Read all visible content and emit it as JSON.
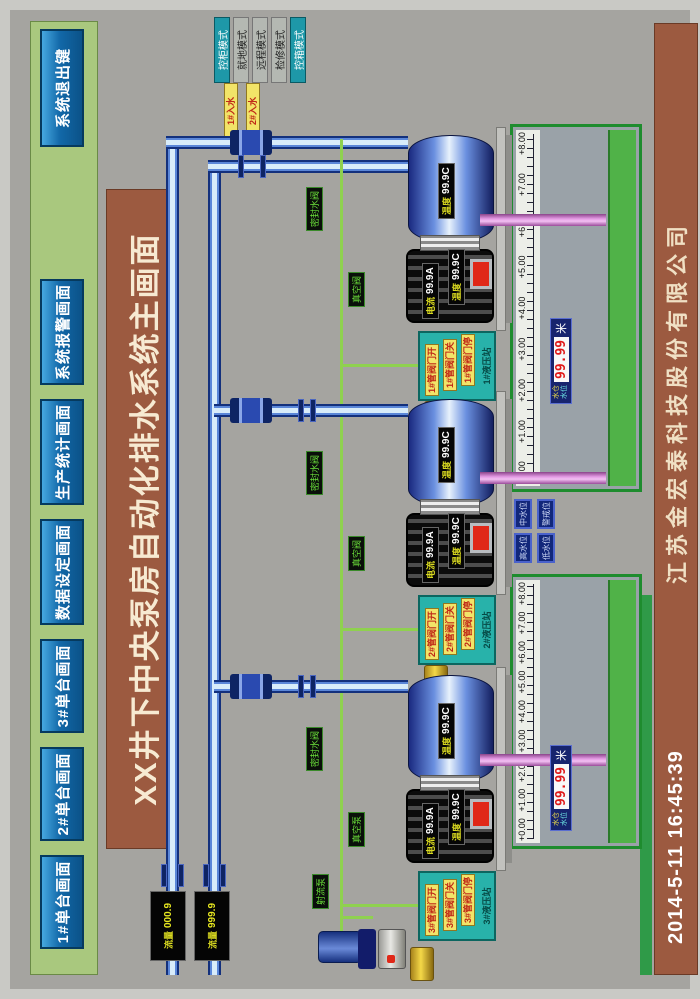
{
  "title": "XX井下中央泵房自动化排水系统主画面",
  "nav": {
    "buttons": [
      "1#单台画面",
      "2#单台画面",
      "3#单台画面",
      "数据设定画面",
      "生产统计画面",
      "系统报警画面"
    ],
    "exit_label": "系统退出键"
  },
  "mode_buttons": [
    "控柜模式",
    "就地模式",
    "远程模式",
    "检修模式",
    "控箱模式"
  ],
  "inlet_labels": [
    "1#入水",
    "2#入水"
  ],
  "flow_meters": [
    {
      "label": "流量",
      "value": "000.9"
    },
    {
      "label": "流量",
      "value": "999.9"
    }
  ],
  "pumps": [
    {
      "id": "1#",
      "hydraulic_station": {
        "title": "1#液压站",
        "valve_labels": [
          "1#管阀门开",
          "1#管阀门关",
          "1#管阀门停"
        ]
      },
      "motor": {
        "current_label": "电流",
        "current": "99.9A",
        "temp_label": "温度",
        "temp": "99.9C"
      },
      "pump_body": {
        "temp_label": "温度",
        "temp": "99.9C"
      },
      "aux_labels": {
        "seal": "密封水阀",
        "vacuum": "真空阀"
      }
    },
    {
      "id": "2#",
      "hydraulic_station": {
        "title": "2#液压站",
        "valve_labels": [
          "2#管阀门开",
          "2#管阀门关",
          "2#管阀门停"
        ]
      },
      "motor": {
        "current_label": "电流",
        "current": "99.9A",
        "temp_label": "温度",
        "temp": "99.9C"
      },
      "pump_body": {
        "temp_label": "温度",
        "temp": "99.9C"
      },
      "aux_labels": {
        "seal": "密封水阀",
        "vacuum": "真空阀"
      }
    },
    {
      "id": "3#",
      "hydraulic_station": {
        "title": "3#液压站",
        "valve_labels": [
          "3#管阀门开",
          "3#管阀门关",
          "3#管阀门停"
        ]
      },
      "motor": {
        "current_label": "电流",
        "current": "99.9A",
        "temp_label": "温度",
        "temp": "99.9C"
      },
      "pump_body": {
        "temp_label": "温度",
        "temp": "99.9C"
      },
      "aux_labels": {
        "seal": "密封水阀",
        "vacuum": "真空泵"
      }
    }
  ],
  "jet_pump_label": "射流泵",
  "level_indicators": [
    "高水位",
    "中水位",
    "低水位",
    "警戒位"
  ],
  "sumps": [
    {
      "scale": [
        "+0.00",
        "+1.00",
        "+2.00",
        "+3.00",
        "+4.00",
        "+5.00",
        "+6.00",
        "+7.00",
        "+8.00"
      ],
      "level_label_1": "水仓",
      "level_label_2": "水位",
      "level_value": "99.99",
      "unit": "米"
    },
    {
      "scale": [
        "+0.00",
        "+1.00",
        "+2.00",
        "+3.00",
        "+4.00",
        "+5.00",
        "+6.00",
        "+7.00",
        "+8.00"
      ],
      "level_label_1": "水仓",
      "level_label_2": "水位",
      "level_value": "99.99",
      "unit": "米"
    }
  ],
  "footer": {
    "datetime": "2014-5-11  16:45:39",
    "company": "江苏金宏泰科技股份有限公司"
  },
  "colors": {
    "background_gray": "#a5a4a0",
    "nav_strip_green": "#a9c87e",
    "button_blue": "#1268a8",
    "bar_brown": "#9c5a40",
    "pipe_blue": "#13307c",
    "control_line_green": "#8fd14f",
    "water_green": "#50b248",
    "discharge_pink": "#e49ae4",
    "hydraulic_teal": "#28b2aa",
    "alarm_red": "#e02818",
    "led_red": "#e01818",
    "label_yellow": "#f2e468"
  }
}
